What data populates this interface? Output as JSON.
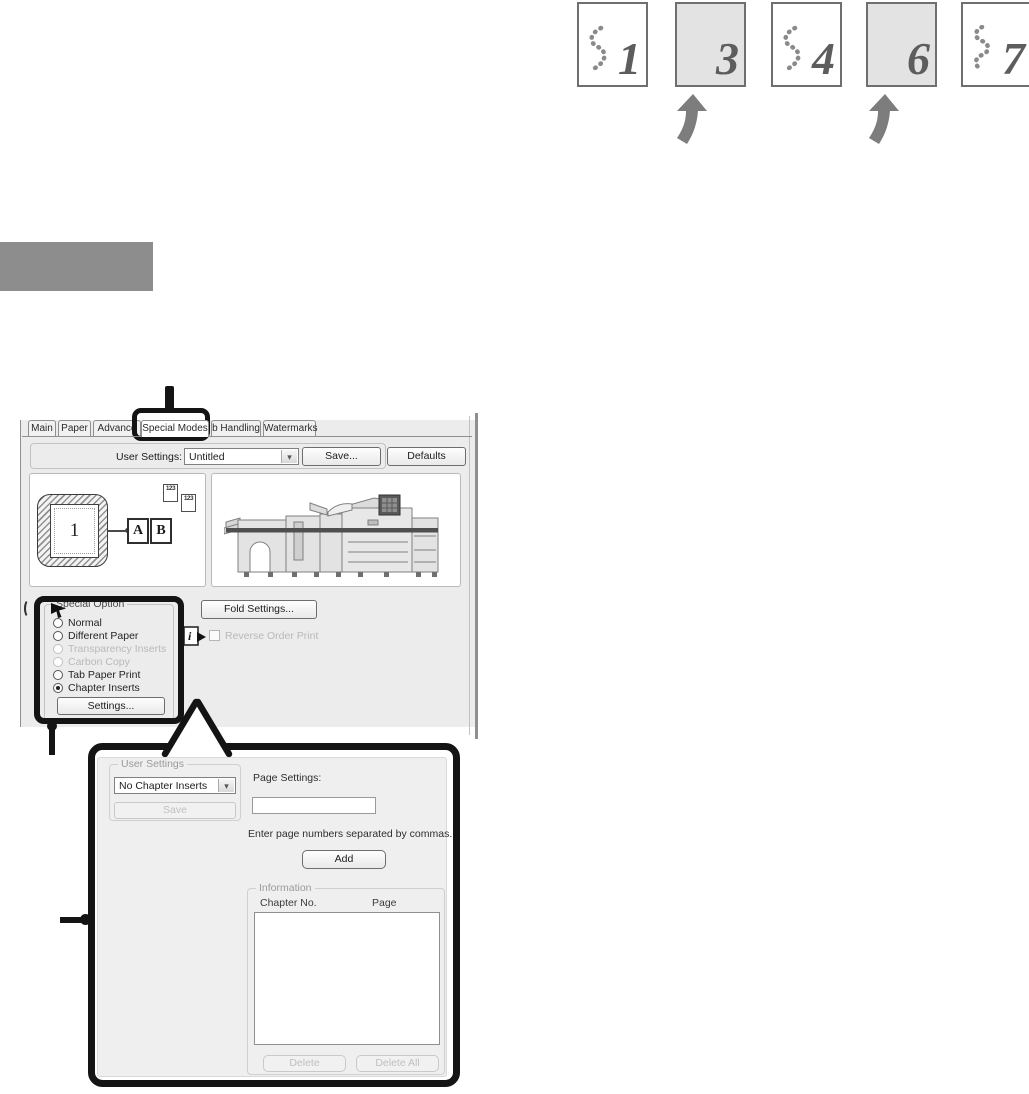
{
  "page_flow": {
    "pages": [
      {
        "number": "1",
        "type": "document-page",
        "decoration": "dotted-squiggle-icon"
      },
      {
        "number": "3",
        "type": "chapter-insert-page",
        "decoration": "none"
      },
      {
        "number": "4",
        "type": "document-page",
        "decoration": "dotted-squiggle-icon"
      },
      {
        "number": "6",
        "type": "chapter-insert-page",
        "decoration": "none"
      },
      {
        "number": "7",
        "type": "document-page",
        "decoration": "dotted-squiggle-icon"
      }
    ],
    "insert_arrow_icon": "up-arrow-icon"
  },
  "dialog": {
    "tabs": [
      {
        "label": "Main"
      },
      {
        "label": "Paper"
      },
      {
        "label": "Advance"
      },
      {
        "label": "Special Modes"
      },
      {
        "label": "b Handling"
      },
      {
        "label": "Watermarks"
      }
    ],
    "selected_tab": "Special Modes",
    "user_settings_bar": {
      "label": "User Settings:",
      "dropdown_value": "Untitled",
      "dropdown_icon": "chevron-down-icon",
      "save": "Save...",
      "defaults": "Defaults"
    },
    "preview": {
      "page_number": "1",
      "left_page": "A",
      "right_page": "B",
      "mini_pages": "123"
    },
    "fold_settings": "Fold Settings...",
    "reverse_order_print": "Reverse Order Print",
    "reverse_order_checked": false,
    "info_cursor_icon": "info-pointer-icon",
    "special_option": {
      "title": "Special Option",
      "options": [
        {
          "label": "Normal",
          "state": "enabled",
          "selected": false
        },
        {
          "label": "Different Paper",
          "state": "enabled",
          "selected": false
        },
        {
          "label": "Transparency Inserts",
          "state": "disabled",
          "selected": false
        },
        {
          "label": "Carbon Copy",
          "state": "disabled",
          "selected": false
        },
        {
          "label": "Tab Paper Print",
          "state": "enabled",
          "selected": false
        },
        {
          "label": "Chapter Inserts",
          "state": "enabled",
          "selected": true
        }
      ],
      "settings": "Settings..."
    }
  },
  "chapter_dialog": {
    "user_settings": {
      "title": "User Settings",
      "dropdown_value": "No Chapter Inserts",
      "dropdown_icon": "chevron-down-icon",
      "save": "Save"
    },
    "page_settings_label": "Page Settings:",
    "page_input_value": "",
    "hint": "Enter page numbers separated by commas.",
    "add": "Add",
    "information": {
      "title": "Information",
      "col_chapter": "Chapter No.",
      "col_page": "Page",
      "rows": [],
      "delete": "Delete",
      "delete_all": "Delete All"
    }
  },
  "colors": {
    "callout": "#141414",
    "heading_gray": "#8d8d8d",
    "insert_page_fill": "#e3e3e3",
    "arrow_gray": "#7d7d7d",
    "dialog_bg": "#ececec"
  }
}
